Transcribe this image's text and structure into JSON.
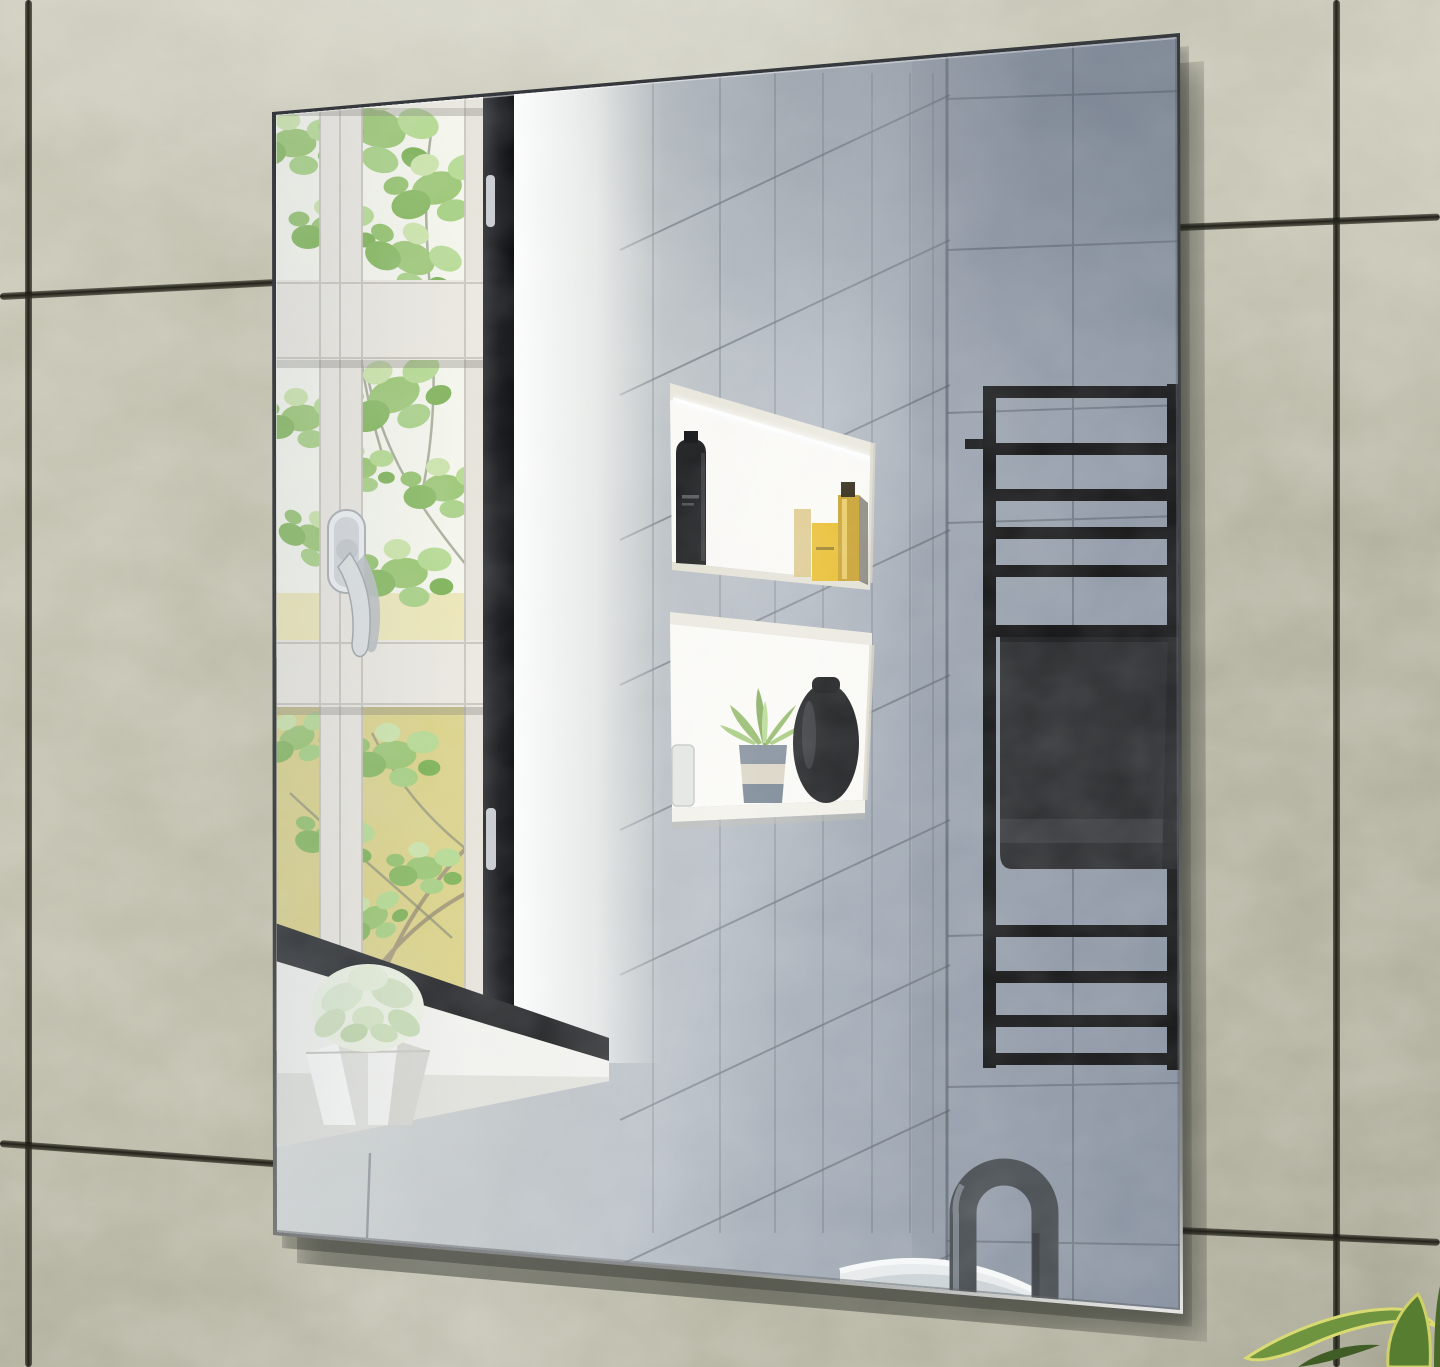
{
  "meta": {
    "title": "Frameless rectangular bathroom wall mirror - lifestyle product photo",
    "width_px": 1440,
    "height_px": 1367
  },
  "wall": {
    "description": "Glossy mottled beige-green ceramic wall tiles with dark grout joints and bright specular sheen",
    "tile_color": "#b8b7a5",
    "grout_color": "#22221a"
  },
  "mirror": {
    "description": "Portrait frameless mirror with polished edge hung at a slight perspective angle, casting a soft shadow to its lower right",
    "edge_color": "#36393b",
    "reflection_summary": "Reflects a bathroom: white casement window with tree foliage, chrome handle, grey shower tiling, two recessed lit niches with toiletries, black ladder towel rail with charcoal towel, gunmetal gooseneck tap over a white basin"
  },
  "reflection": {
    "window": {
      "description": "White casement window, six panes in two columns, green tree foliage over a pale yellow wall outside",
      "frame_color": "#ebe9e1",
      "dark_edge_color": "#17181c",
      "handle": "Chrome espagnolette window handle with twin levers",
      "sill": "White windowsill with dark lower sash band"
    },
    "planter": {
      "description": "White faceted origami-style planter with pale green succulent rosette",
      "color": "#f1f1ee"
    },
    "shower_wall": {
      "description": "Corner of tiled shower: narrow vertical tiles receding on the side wall, larger grey tiles on the back wall",
      "tile_color": "#b3bac1",
      "grout_color": "#6f7680"
    },
    "niche_upper": {
      "description": "Recessed wall niche with LED strip light",
      "items": [
        "black toiletry bottle with grey label text",
        "pale gold flask",
        "yellow-gold bottle",
        "tall amber pump bottle with dark cap"
      ]
    },
    "niche_lower": {
      "description": "Recessed shelf niche",
      "items": [
        "small glass jar",
        "succulent in blue-grey and cream striped pot",
        "black rounded vase"
      ]
    },
    "towel_rail": {
      "description": "Matte black ladder towel radiator, five bars above and four below the towel",
      "bar_color": "#151516",
      "towel": {
        "description": "Charcoal towel draped over a middle bar with woven hem band",
        "color": "#2b2c2e"
      }
    },
    "faucet": {
      "description": "Gunmetal gooseneck basin tap",
      "color": "#464b50"
    },
    "basin": {
      "description": "White basin rim at the mirror's lower edge",
      "color": "#eceff0"
    }
  },
  "foreground": {
    "plant": {
      "description": "Variegated snake-plant leaves entering the bottom-right corner",
      "leaf_green": "#5d8136",
      "leaf_edge": "#d6d671"
    }
  },
  "palette": {
    "wall_tile": "#b8b7a5",
    "wall_grout": "#22221a",
    "mirror_grey": "#a9b0ba",
    "niche_white": "#fbfaf6",
    "towel": "#2b2c2e",
    "rack_black": "#151516",
    "amber": "#c8961e",
    "foliage_green": "#9cc873",
    "yellow_wall": "#ddd48a",
    "chrome": "#d6dadd"
  }
}
